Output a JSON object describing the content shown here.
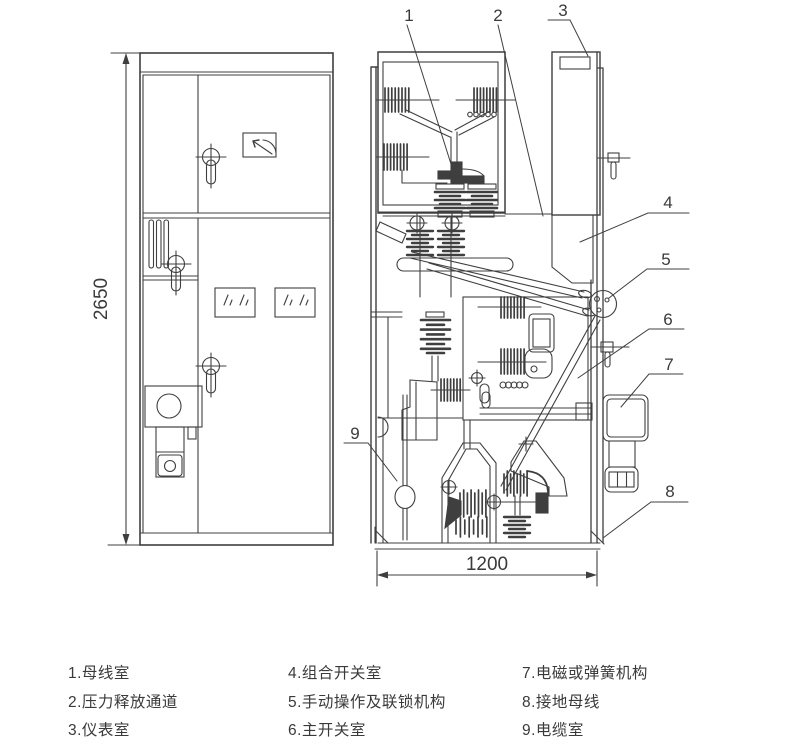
{
  "colors": {
    "background": "#ffffff",
    "line": "#3f3f3f",
    "text": "#3a3a3a"
  },
  "front_view": {
    "height_dimension": "2650"
  },
  "section_view": {
    "width_dimension": "1200"
  },
  "callouts": {
    "c1": "1",
    "c2": "2",
    "c3": "3",
    "c4": "4",
    "c5": "5",
    "c6": "6",
    "c7": "7",
    "c8": "8",
    "c9": "9"
  },
  "legend": {
    "columns": [
      {
        "items": [
          "1.母线室",
          "2.压力释放通道",
          "3.仪表室"
        ]
      },
      {
        "items": [
          "4.组合开关室",
          "5.手动操作及联锁机构",
          "6.主开关室"
        ]
      },
      {
        "items": [
          "7.电磁或弹簧机构",
          "8.接地母线",
          "9.电缆室"
        ]
      }
    ]
  }
}
